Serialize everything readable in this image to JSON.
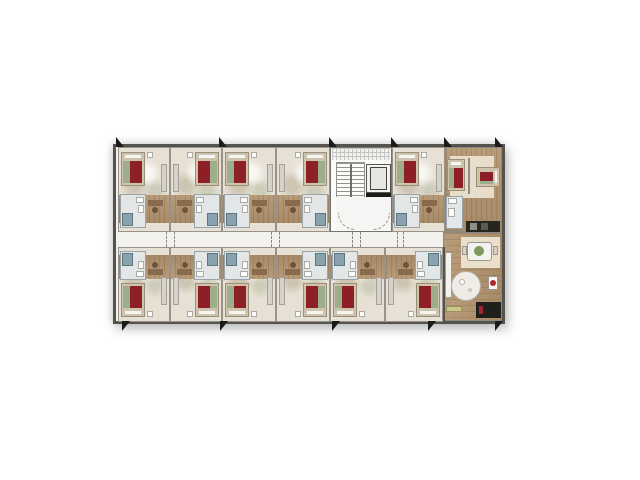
{
  "scene": {
    "type": "hotel-floor-plan-render",
    "width": 640,
    "height": 480,
    "background": "#ffffff"
  },
  "palette": {
    "wall": "#55534e",
    "wall_light": "#97938b",
    "floor_beige": "#e7e1d5",
    "corridor": "#f3f2ef",
    "wood": "#ab8f6d",
    "bath_tile": "#e2e6e7",
    "shower_teal": "#8aa2ad",
    "bed_red": "#8d1f26",
    "bed_frame": "#cfc3ab",
    "pillow_white": "#f7f5f0",
    "accent_green": "#9dae8c",
    "plant_green": "#7c9a60",
    "dark_furniture": "#1f1f1c",
    "marker_black": "#1b1b19"
  },
  "building": {
    "x": 113,
    "y": 144,
    "w": 392,
    "h": 180
  },
  "corridor": {
    "x": 116,
    "y": 232,
    "w": 329,
    "h": 15
  },
  "rooms": [
    {
      "id": "guestroom-top-1",
      "x": 118,
      "y": 147,
      "w": 52,
      "h": 85,
      "band": "top",
      "mirror": false
    },
    {
      "id": "guestroom-top-2",
      "x": 170,
      "y": 147,
      "w": 52,
      "h": 85,
      "band": "top",
      "mirror": true
    },
    {
      "id": "guestroom-top-3",
      "x": 222,
      "y": 147,
      "w": 54,
      "h": 85,
      "band": "top",
      "mirror": false
    },
    {
      "id": "guestroom-top-4",
      "x": 276,
      "y": 147,
      "w": 54,
      "h": 85,
      "band": "top",
      "mirror": true
    },
    {
      "id": "guestroom-top-5",
      "x": 392,
      "y": 147,
      "w": 53,
      "h": 85,
      "band": "top",
      "mirror": false
    },
    {
      "id": "guestroom-bottom-1",
      "x": 118,
      "y": 247,
      "w": 52,
      "h": 75,
      "band": "bottom",
      "mirror": false
    },
    {
      "id": "guestroom-bottom-2",
      "x": 170,
      "y": 247,
      "w": 52,
      "h": 75,
      "band": "bottom",
      "mirror": true
    },
    {
      "id": "guestroom-bottom-3",
      "x": 222,
      "y": 247,
      "w": 54,
      "h": 75,
      "band": "bottom",
      "mirror": false
    },
    {
      "id": "guestroom-bottom-4",
      "x": 276,
      "y": 247,
      "w": 54,
      "h": 75,
      "band": "bottom",
      "mirror": true
    },
    {
      "id": "guestroom-bottom-5",
      "x": 330,
      "y": 247,
      "w": 55,
      "h": 75,
      "band": "bottom",
      "mirror": false
    },
    {
      "id": "guestroom-bottom-6",
      "x": 385,
      "y": 247,
      "w": 58,
      "h": 75,
      "band": "bottom",
      "mirror": true
    }
  ],
  "extras": [
    {
      "n": "stair-core",
      "t": "rect",
      "x": 330,
      "y": 147,
      "w": 62,
      "h": 85,
      "f": "#fafaf8",
      "s": "#72726e"
    },
    {
      "n": "stair-window-grid",
      "t": "rect",
      "x": 332,
      "y": 148,
      "w": 58,
      "h": 12,
      "cls": "grid"
    },
    {
      "n": "stair-flight",
      "t": "rect",
      "x": 336,
      "y": 162,
      "w": 29,
      "h": 52,
      "cls": "treads"
    },
    {
      "n": "stair-rail",
      "t": "rect",
      "x": 350,
      "y": 164,
      "w": 2,
      "h": 47,
      "f": "#6e6e6a"
    },
    {
      "n": "elevator-shaft",
      "t": "rect",
      "x": 366,
      "y": 164,
      "w": 25,
      "h": 29,
      "f": "#f3f3f1",
      "s": "#55554f"
    },
    {
      "n": "elevator-car",
      "t": "rect",
      "x": 370,
      "y": 167,
      "w": 17,
      "h": 23,
      "f": "#e6e6e3",
      "s": "#44443f"
    },
    {
      "n": "elevator-door-wall",
      "t": "rect",
      "x": 366,
      "y": 193,
      "w": 25,
      "h": 4,
      "f": "#1c1c1a"
    },
    {
      "n": "stair-lobby",
      "t": "rect",
      "x": 336,
      "y": 197,
      "w": 55,
      "h": 33,
      "f": "#f6f5f3"
    },
    {
      "n": "lobby-door-arc-left",
      "t": "arc",
      "x": 338,
      "y": 213,
      "r": 17,
      "dir": "bl"
    },
    {
      "n": "lobby-door-arc-right",
      "t": "arc",
      "x": 373,
      "y": 213,
      "r": 17,
      "dir": "br"
    },
    {
      "n": "suite-floor",
      "t": "rect",
      "x": 445,
      "y": 147,
      "w": 57,
      "h": 85,
      "cls": "wood",
      "s": "#8a8a84"
    },
    {
      "n": "suite-rug",
      "t": "rect",
      "x": 450,
      "y": 156,
      "w": 44,
      "h": 42,
      "f": "#e7ddca"
    },
    {
      "n": "suite-partition-wall",
      "t": "rect",
      "x": 468,
      "y": 158,
      "w": 2,
      "h": 36,
      "f": "#8d8d87"
    },
    {
      "n": "suite-bed-1",
      "t": "bed",
      "x": 447,
      "y": 159,
      "w": 18,
      "h": 32,
      "dir": "v"
    },
    {
      "n": "suite-bed-2",
      "t": "bed",
      "x": 476,
      "y": 167,
      "w": 24,
      "h": 20,
      "dir": "h"
    },
    {
      "n": "suite-bathroom",
      "t": "rect",
      "x": 446,
      "y": 196,
      "w": 17,
      "h": 33,
      "f": "#e3e7e8",
      "s": "#9aa4a8"
    },
    {
      "n": "suite-bath-sink",
      "t": "rect",
      "x": 448,
      "y": 198,
      "w": 9,
      "h": 6,
      "f": "#fbfbfa",
      "s": "#a9a9a5"
    },
    {
      "n": "suite-bath-toilet",
      "t": "rect",
      "x": 448,
      "y": 208,
      "w": 7,
      "h": 9,
      "f": "#fbfbfa",
      "s": "#a9a9a5"
    },
    {
      "n": "suite-kitchenette",
      "t": "rect",
      "x": 466,
      "y": 221,
      "w": 34,
      "h": 11,
      "f": "#26261f"
    },
    {
      "n": "kitchen-appliance-1",
      "t": "rect",
      "x": 470,
      "y": 223,
      "w": 7,
      "h": 7,
      "f": "#8f8f89"
    },
    {
      "n": "kitchen-appliance-2",
      "t": "rect",
      "x": 481,
      "y": 223,
      "w": 7,
      "h": 7,
      "f": "#5a5a54"
    },
    {
      "n": "lounge-floor",
      "t": "rect",
      "x": 443,
      "y": 232,
      "w": 59,
      "h": 89,
      "cls": "woodv",
      "s": "#8a8a84"
    },
    {
      "n": "lounge-left-wall",
      "t": "rect",
      "x": 443,
      "y": 247,
      "w": 2,
      "h": 74,
      "f": "#55534e"
    },
    {
      "n": "dining-rug",
      "t": "rect",
      "x": 461,
      "y": 237,
      "w": 39,
      "h": 31,
      "f": "#e9dfca"
    },
    {
      "n": "dining-table",
      "t": "rect",
      "x": 467,
      "y": 242,
      "w": 25,
      "h": 19,
      "f": "#f4f2ee",
      "s": "#9a968e",
      "r": 3
    },
    {
      "n": "dining-plant",
      "t": "circle",
      "cx": 479,
      "cy": 251,
      "r": 5,
      "f": "#7c9a60"
    },
    {
      "n": "dining-chair-1",
      "t": "rect",
      "x": 462,
      "y": 246,
      "w": 5,
      "h": 9,
      "f": "#d9d3c7",
      "s": "#9a968e"
    },
    {
      "n": "dining-chair-2",
      "t": "rect",
      "x": 493,
      "y": 246,
      "w": 5,
      "h": 9,
      "f": "#d9d3c7",
      "s": "#9a968e"
    },
    {
      "n": "lounge-cabinet",
      "t": "rect",
      "x": 445,
      "y": 252,
      "w": 7,
      "h": 46,
      "f": "#f3f2ef",
      "s": "#a09c94"
    },
    {
      "n": "round-table",
      "t": "circle",
      "cx": 466,
      "cy": 286,
      "r": 15,
      "f": "#efece6",
      "s": "#b5b1a9"
    },
    {
      "n": "round-table-item-1",
      "t": "circle",
      "cx": 462,
      "cy": 282,
      "r": 3,
      "f": "#ffffff",
      "s": "#b5b1a9"
    },
    {
      "n": "round-table-item-2",
      "t": "circle",
      "cx": 470,
      "cy": 290,
      "r": 2,
      "f": "#cfc9bb"
    },
    {
      "n": "side-table",
      "t": "rect",
      "x": 488,
      "y": 276,
      "w": 10,
      "h": 14,
      "f": "#f6f5f2",
      "s": "#9a968e"
    },
    {
      "n": "side-table-lamp",
      "t": "circle",
      "cx": 493,
      "cy": 283,
      "r": 3,
      "f": "#b02330"
    },
    {
      "n": "media-desk",
      "t": "rect",
      "x": 476,
      "y": 302,
      "w": 25,
      "h": 16,
      "f": "#1f1f1c"
    },
    {
      "n": "media-desk-accent",
      "t": "rect",
      "x": 479,
      "y": 306,
      "w": 4,
      "h": 8,
      "f": "#a12530"
    },
    {
      "n": "lounge-bench",
      "t": "rect",
      "x": 446,
      "y": 306,
      "w": 16,
      "h": 6,
      "f": "#cdc68c",
      "s": "#97915c"
    }
  ],
  "door_dashes": [
    {
      "n": "door-swing-dash",
      "x": 166,
      "y": 232,
      "h": 15
    },
    {
      "n": "door-swing-dash",
      "x": 174,
      "y": 232,
      "h": 15
    },
    {
      "n": "door-swing-dash",
      "x": 271,
      "y": 232,
      "h": 15
    },
    {
      "n": "door-swing-dash",
      "x": 279,
      "y": 232,
      "h": 15
    },
    {
      "n": "door-swing-dash",
      "x": 352,
      "y": 232,
      "h": 15
    },
    {
      "n": "door-swing-dash",
      "x": 360,
      "y": 232,
      "h": 15
    },
    {
      "n": "door-swing-dash",
      "x": 397,
      "y": 232,
      "h": 15
    },
    {
      "n": "door-swing-dash",
      "x": 403,
      "y": 232,
      "h": 15
    }
  ],
  "wall_markers": {
    "top": [
      116,
      219,
      329,
      391,
      444,
      495
    ],
    "top_y": 137,
    "bottom": [
      122,
      220,
      332,
      428,
      495
    ],
    "bottom_y": 321
  }
}
